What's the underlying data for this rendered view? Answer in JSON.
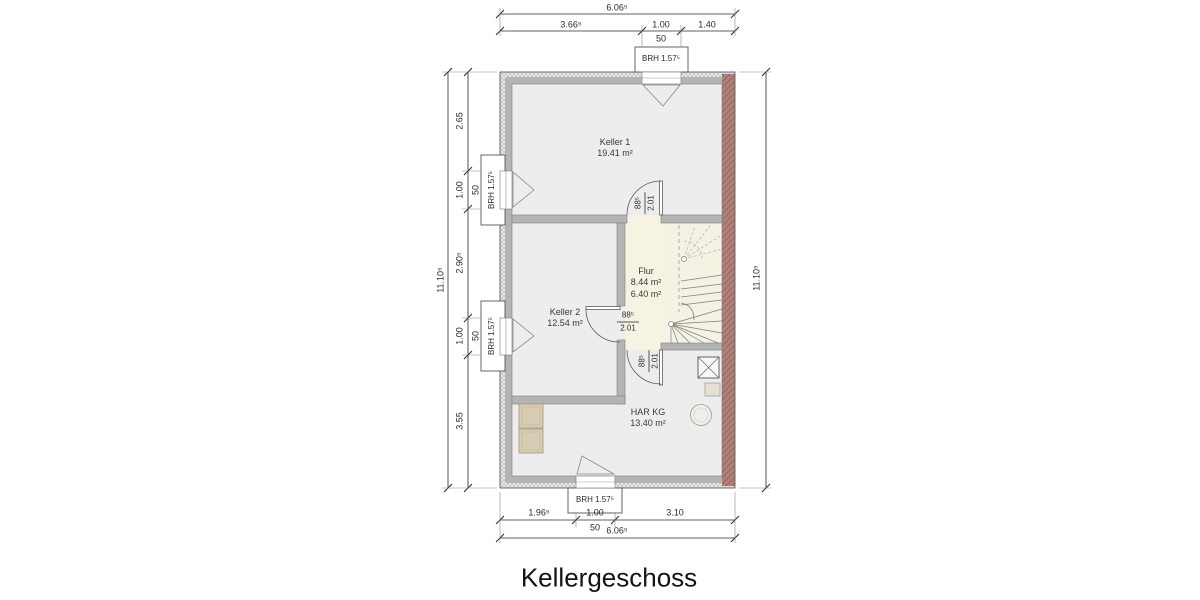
{
  "title": "Kellergeschoss",
  "rooms": {
    "keller1": {
      "name": "Keller 1",
      "area": "19.41 m²"
    },
    "keller2": {
      "name": "Keller 2",
      "area": "12.54 m²"
    },
    "flur": {
      "name": "Flur",
      "area1": "8.44 m²",
      "area2": "6.40 m²"
    },
    "har": {
      "name": "HAR KG",
      "area": "13.40 m²"
    }
  },
  "door_label": {
    "w": "88⁵",
    "h": "2.01"
  },
  "window_label": "BRH 1.57⁵",
  "dims": {
    "top": {
      "overall": "6.06⁵",
      "seg": [
        "3.66⁵",
        "1.00",
        "1.40"
      ],
      "sub": "50"
    },
    "bottom": {
      "overall": "6.06⁵",
      "seg": [
        "1.96⁵",
        "1.00",
        "3.10"
      ],
      "sub": "50"
    },
    "left": {
      "overall": "11.10⁵",
      "seg": [
        "2.65",
        "1.00",
        "2.90⁵",
        "1.00",
        "3.55"
      ],
      "subs": [
        "50",
        "50"
      ]
    },
    "right": {
      "overall": "11.10⁵"
    }
  },
  "colors": {
    "wall": "#b4b4b4",
    "party_wall": "#b18179",
    "insulation_band": "#e9e9e9",
    "floor": "#ededed",
    "flur_floor": "#f6f3e2",
    "stair_floor": "#f5f2e3",
    "appliance": "#d8cdb2",
    "line": "#2b2b2b"
  }
}
